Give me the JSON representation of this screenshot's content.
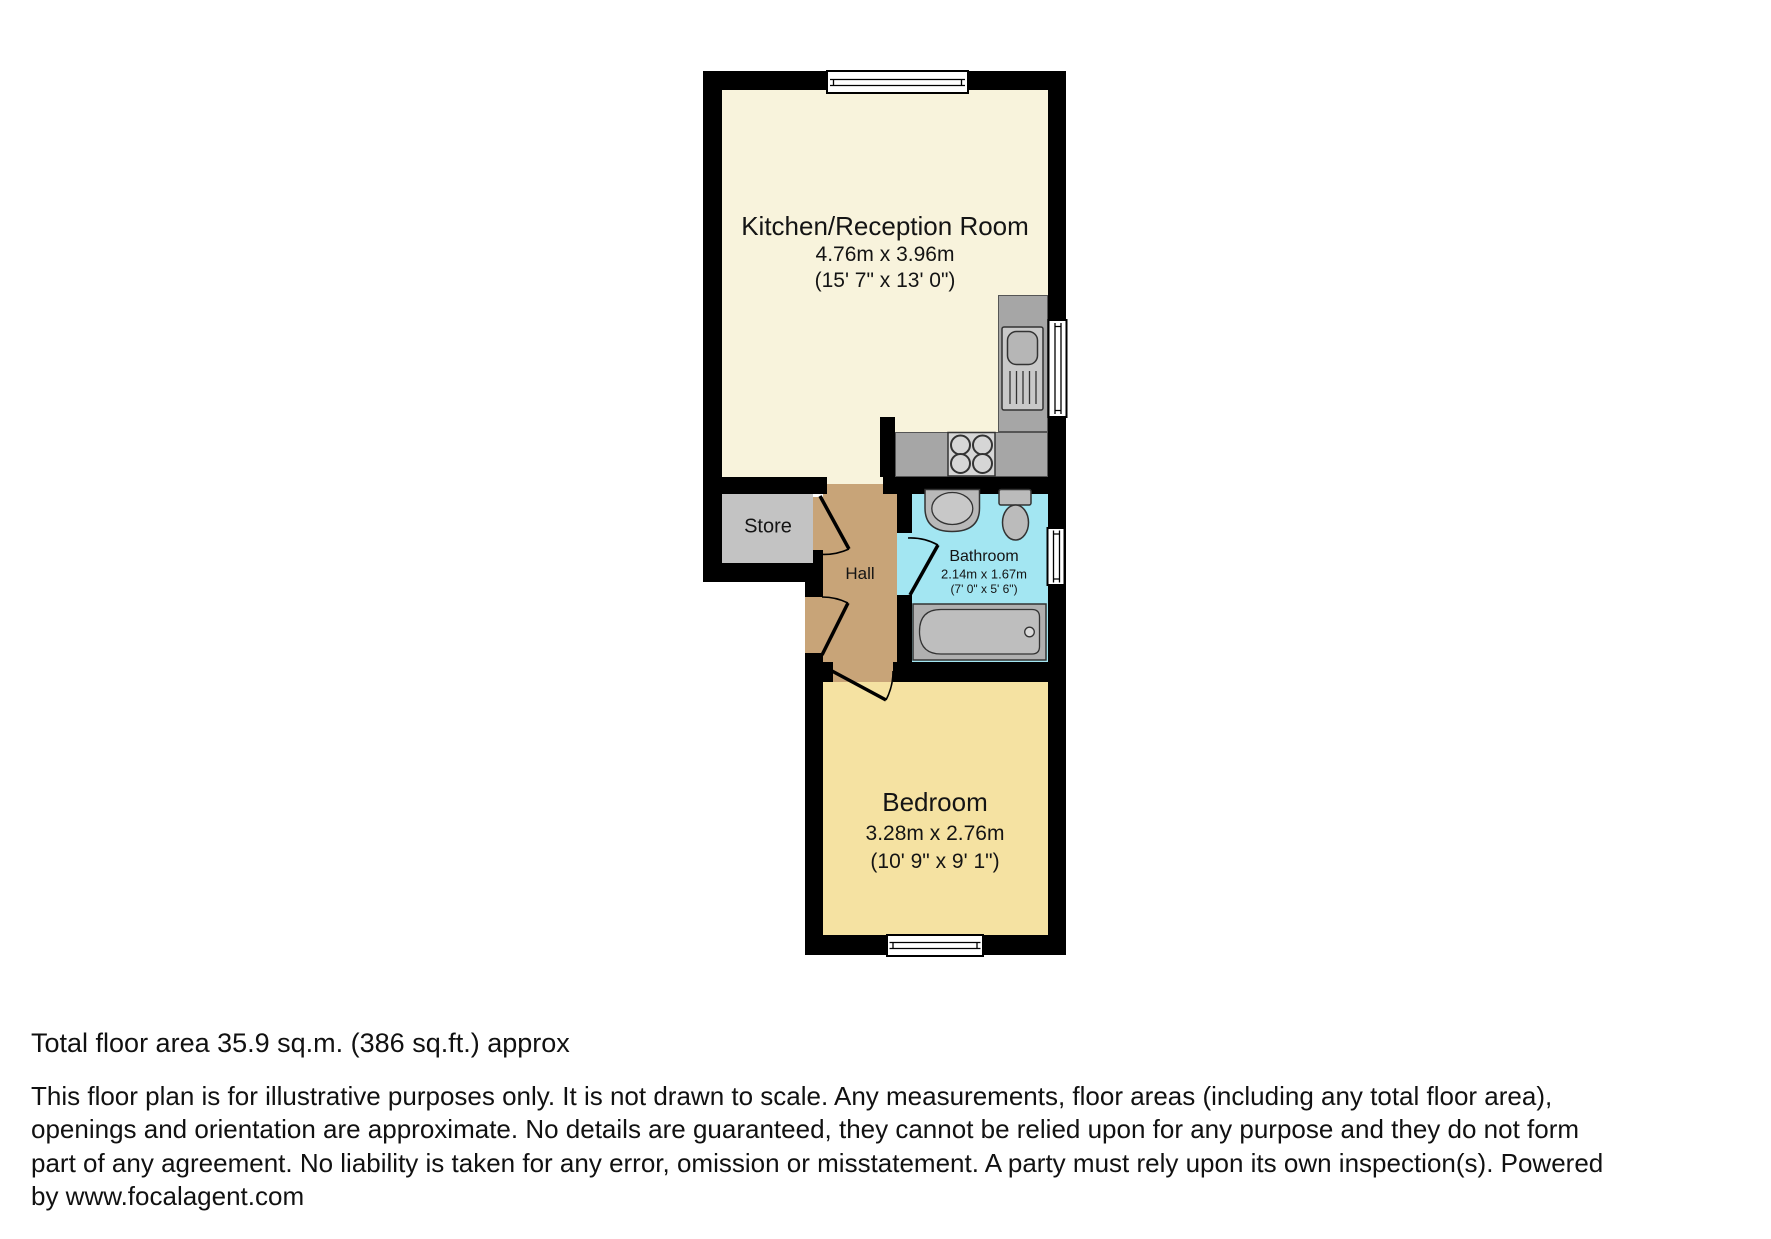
{
  "plan": {
    "rooms": {
      "kitchen": {
        "name": "Kitchen/Reception Room",
        "dims_metric": "4.76m x 3.96m",
        "dims_imperial": "(15' 7\" x 13' 0\")"
      },
      "store": {
        "name": "Store"
      },
      "hall": {
        "name": "Hall"
      },
      "bathroom": {
        "name": "Bathroom",
        "dims_metric": "2.14m x 1.67m",
        "dims_imperial": "(7' 0\" x 5' 6\")"
      },
      "bedroom": {
        "name": "Bedroom",
        "dims_metric": "3.28m x 2.76m",
        "dims_imperial": "(10' 9\" x 9' 1\")"
      }
    },
    "colors": {
      "wall": "#000000",
      "kitchen_floor": "#F8F3DC",
      "bedroom_floor": "#F5E2A2",
      "bathroom_floor": "#A3E6F2",
      "hall_floor": "#C8A478",
      "store_floor": "#C3C3C3",
      "counter": "#A6A6A6"
    }
  },
  "footer": {
    "total_area": "Total floor area 35.9 sq.m. (386 sq.ft.) approx",
    "disclaimer_lines": [
      "This floor plan is for illustrative purposes only. It is not drawn to scale. Any measurements, floor areas (including any total floor area),",
      "openings and orientation are approximate. No details are guaranteed, they cannot be relied upon for any purpose and they do not form",
      "part of any agreement. No liability is taken for any error, omission or misstatement. A party must rely upon its own inspection(s). Powered",
      "by www.focalagent.com"
    ]
  }
}
